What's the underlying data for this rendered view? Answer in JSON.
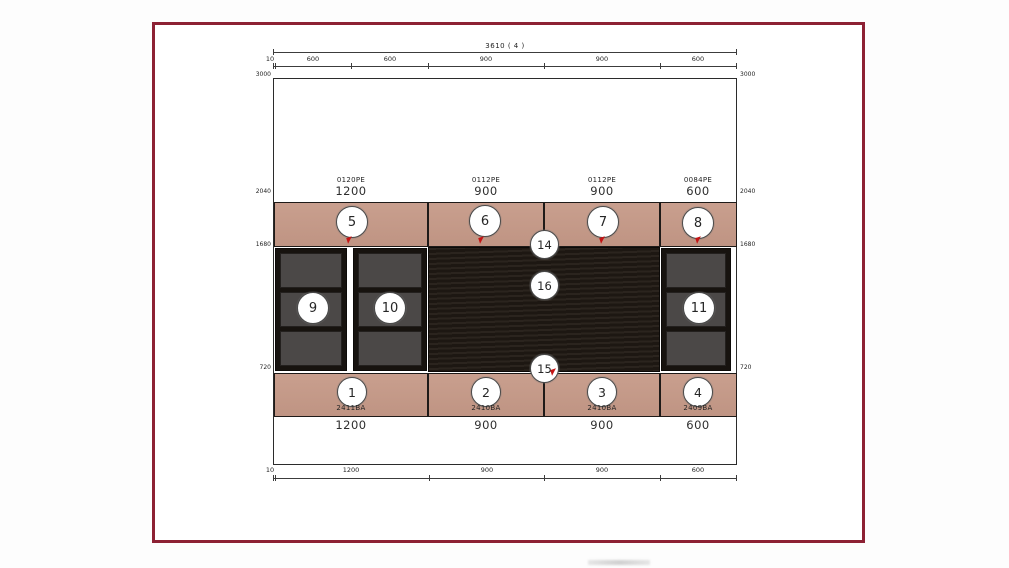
{
  "dimensions": {
    "top_total": "3610 ( 4 )",
    "top_segments": [
      "10",
      "600",
      "600",
      "900",
      "900",
      "600"
    ],
    "bottom_segments": [
      "10",
      "1200",
      "900",
      "900",
      "600"
    ],
    "levels_left": [
      "3000",
      "2040",
      "1680",
      "720"
    ],
    "levels_right": [
      "3000",
      "2040",
      "1680",
      "720"
    ]
  },
  "upper_cabinets": [
    {
      "num": "5",
      "code": "0120PE",
      "width": "1200"
    },
    {
      "num": "6",
      "code": "0112PE",
      "width": "900"
    },
    {
      "num": "7",
      "code": "0112PE",
      "width": "900"
    },
    {
      "num": "8",
      "code": "0084PE",
      "width": "600"
    }
  ],
  "lower_cabinets": [
    {
      "num": "1",
      "code": "2411BA",
      "width": "1200"
    },
    {
      "num": "2",
      "code": "2410BA",
      "width": "900"
    },
    {
      "num": "3",
      "code": "2410BA",
      "width": "900"
    },
    {
      "num": "4",
      "code": "2409BA",
      "width": "600"
    }
  ],
  "shelf_units": [
    {
      "num": "9"
    },
    {
      "num": "10"
    },
    {
      "num": "11"
    }
  ],
  "markers": {
    "top_center": "14",
    "panel_center": "16",
    "bottom_center": "15"
  },
  "colors": {
    "frame_maroon": "#8d2134",
    "cabinet_tan": "#c49a89",
    "panel_dark": "#231c16",
    "shelf_gray": "#4b4847",
    "accent_red": "#c41414"
  }
}
